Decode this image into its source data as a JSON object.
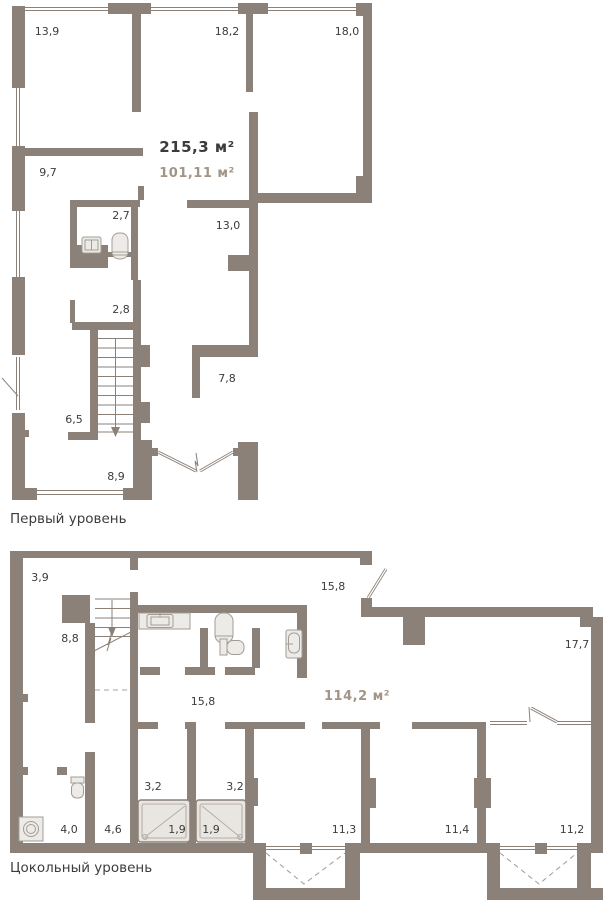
{
  "colors": {
    "wall": "#8B8178",
    "accent_area": "#A39585",
    "label_text": "#3C3C3C",
    "fixture_fill": "#EDEBE7",
    "dashed_line": "#A9A29B"
  },
  "levels": [
    {
      "caption": "Первый уровень",
      "total_area": "215,3 м²",
      "secondary_area": "101,11 м²",
      "rooms": [
        {
          "label": "13,9"
        },
        {
          "label": "18,2"
        },
        {
          "label": "18,0"
        },
        {
          "label": "9,7"
        },
        {
          "label": "2,7"
        },
        {
          "label": "13,0"
        },
        {
          "label": "2,8"
        },
        {
          "label": "7,8"
        },
        {
          "label": "6,5"
        },
        {
          "label": "8,9"
        }
      ]
    },
    {
      "caption": "Цокольный уровень",
      "area": "114,2 м²",
      "rooms": [
        {
          "label": "3,9"
        },
        {
          "label": "15,8"
        },
        {
          "label": "8,8"
        },
        {
          "label": "17,7"
        },
        {
          "label": "15,8"
        },
        {
          "label": "3,2"
        },
        {
          "label": "3,2"
        },
        {
          "label": "4,0"
        },
        {
          "label": "4,6"
        },
        {
          "label": "1,9"
        },
        {
          "label": "1,9"
        },
        {
          "label": "11,3"
        },
        {
          "label": "11,4"
        },
        {
          "label": "11,2"
        }
      ]
    }
  ]
}
